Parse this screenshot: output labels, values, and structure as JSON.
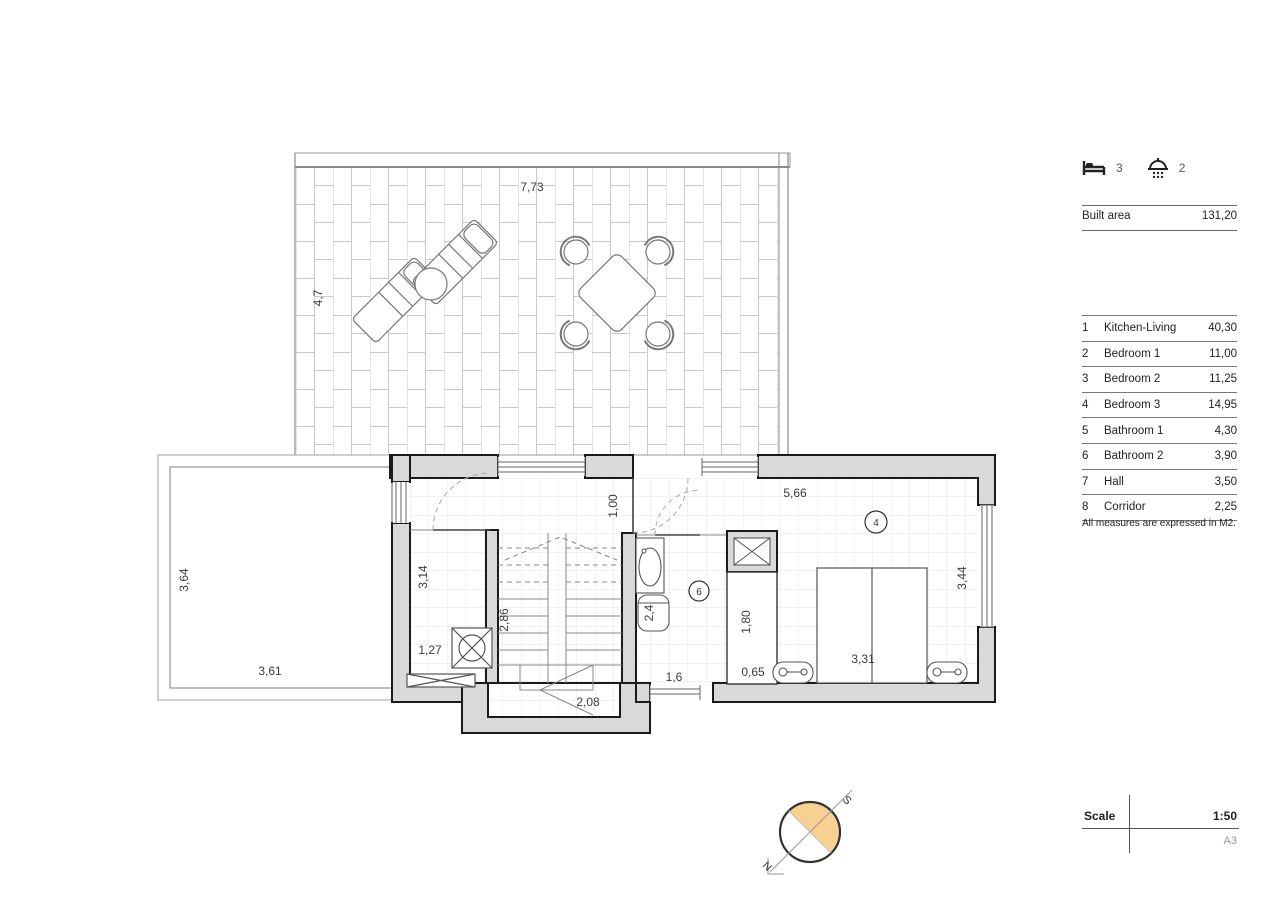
{
  "header": {
    "bedrooms_count": "3",
    "bathrooms_count": "2"
  },
  "summary": {
    "built_area_label": "Built area",
    "built_area_value": "131,20"
  },
  "rooms_table": {
    "rows": [
      {
        "num": "1",
        "name": "Kitchen-Living",
        "area": "40,30"
      },
      {
        "num": "2",
        "name": "Bedroom 1",
        "area": "11,00"
      },
      {
        "num": "3",
        "name": "Bedroom 2",
        "area": "11,25"
      },
      {
        "num": "4",
        "name": "Bedroom 3",
        "area": "14,95"
      },
      {
        "num": "5",
        "name": "Bathroom 1",
        "area": "4,30"
      },
      {
        "num": "6",
        "name": "Bathroom 2",
        "area": "3,90"
      },
      {
        "num": "7",
        "name": "Hall",
        "area": "3,50"
      },
      {
        "num": "8",
        "name": "Corridor",
        "area": "2,25"
      }
    ]
  },
  "note": "All measures are expressed in M2.",
  "title_block": {
    "scale_label": "Scale",
    "scale_value": "1:50",
    "paper_size": "A3"
  },
  "compass": {
    "north": "N",
    "south": "S"
  },
  "plan": {
    "dimensions": {
      "terrace_width": "7,73",
      "terrace_depth": "4,7",
      "patio_depth": "3,64",
      "patio_width": "3,61",
      "utility_depth": "3,14",
      "utility_width": "1,27",
      "stairs_depth": "2,86",
      "stairs_landing": "2,08",
      "hall_width": "1,00",
      "bedroom_width": "5,66",
      "bedroom_depth": "3,44",
      "bed_width": "3,31",
      "wardrobe_depth": "1,80",
      "wardrobe_width": "0,65",
      "bath_window_width": "1,6",
      "toilet_width": "2,4"
    },
    "markers": {
      "bedroom3": "4",
      "bathroom2": "6"
    }
  },
  "colors": {
    "wall_fill": "#d9d9d9",
    "compass_fill": "#f7d092",
    "line": "#1a1a1a"
  }
}
